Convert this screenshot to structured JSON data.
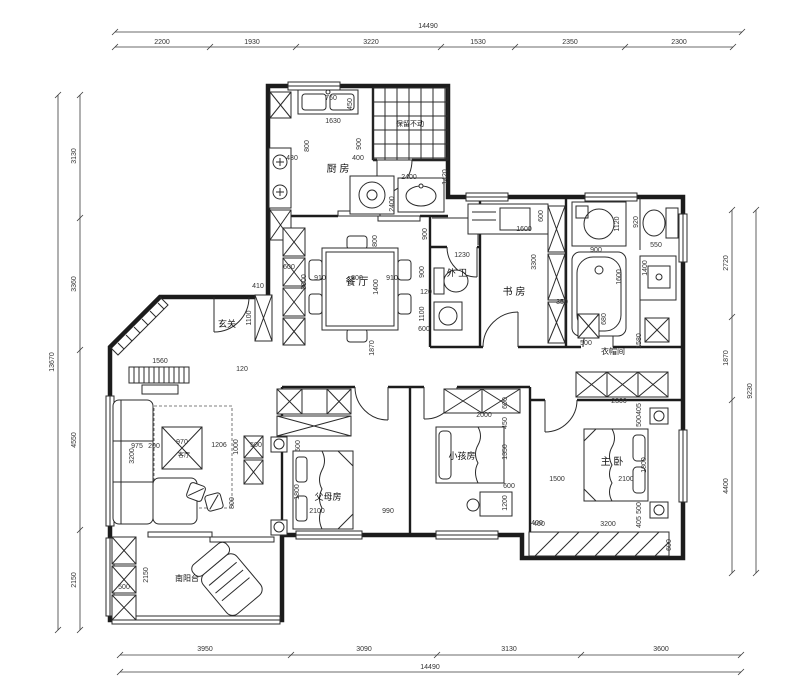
{
  "plan": {
    "rooms": [
      {
        "name": "厨 房",
        "x": 338,
        "y": 172,
        "s": 10
      },
      {
        "name": "保留不动",
        "x": 410,
        "y": 126,
        "s": 7
      },
      {
        "name": "餐 厅",
        "x": 357,
        "y": 285,
        "s": 10
      },
      {
        "name": "玄关",
        "x": 227,
        "y": 327,
        "s": 9
      },
      {
        "name": "外 卫",
        "x": 457,
        "y": 276,
        "s": 9
      },
      {
        "name": "书 房",
        "x": 514,
        "y": 295,
        "s": 10
      },
      {
        "name": "衣帽间",
        "x": 613,
        "y": 354,
        "s": 8
      },
      {
        "name": "客厅",
        "x": 184,
        "y": 457,
        "s": 6
      },
      {
        "name": "父母房",
        "x": 328,
        "y": 500,
        "s": 9
      },
      {
        "name": "小孩房",
        "x": 462,
        "y": 459,
        "s": 9
      },
      {
        "name": "主 卧",
        "x": 612,
        "y": 465,
        "s": 10
      },
      {
        "name": "南阳台",
        "x": 187,
        "y": 581,
        "s": 8
      }
    ],
    "annotations": [
      {
        "t": "14490",
        "x": 428,
        "y": 28
      },
      {
        "t": "2200",
        "x": 162,
        "y": 44
      },
      {
        "t": "1930",
        "x": 252,
        "y": 44
      },
      {
        "t": "3220",
        "x": 371,
        "y": 44
      },
      {
        "t": "1530",
        "x": 478,
        "y": 44
      },
      {
        "t": "2350",
        "x": 570,
        "y": 44
      },
      {
        "t": "2300",
        "x": 679,
        "y": 44
      },
      {
        "t": "3950",
        "x": 205,
        "y": 651
      },
      {
        "t": "3090",
        "x": 364,
        "y": 651
      },
      {
        "t": "3130",
        "x": 509,
        "y": 651
      },
      {
        "t": "3600",
        "x": 661,
        "y": 651
      },
      {
        "t": "14490",
        "x": 430,
        "y": 669
      },
      {
        "t": "13670",
        "x": 54,
        "y": 362,
        "r": 1
      },
      {
        "t": "3130",
        "x": 76,
        "y": 156,
        "r": 1
      },
      {
        "t": "3360",
        "x": 76,
        "y": 284,
        "r": 1
      },
      {
        "t": "4550",
        "x": 76,
        "y": 440,
        "r": 1
      },
      {
        "t": "2150",
        "x": 76,
        "y": 580,
        "r": 1
      },
      {
        "t": "2720",
        "x": 728,
        "y": 263,
        "r": 1
      },
      {
        "t": "1870",
        "x": 728,
        "y": 358,
        "r": 1
      },
      {
        "t": "4400",
        "x": 728,
        "y": 486,
        "r": 1
      },
      {
        "t": "9230",
        "x": 752,
        "y": 391,
        "r": 1
      },
      {
        "t": "760",
        "x": 331,
        "y": 100
      },
      {
        "t": "450",
        "x": 352,
        "y": 104,
        "r": 1
      },
      {
        "t": "1630",
        "x": 333,
        "y": 123
      },
      {
        "t": "800",
        "x": 309,
        "y": 146,
        "r": 1
      },
      {
        "t": "900",
        "x": 361,
        "y": 144,
        "r": 1
      },
      {
        "t": "430",
        "x": 292,
        "y": 160
      },
      {
        "t": "400",
        "x": 358,
        "y": 160
      },
      {
        "t": "2400",
        "x": 409,
        "y": 179
      },
      {
        "t": "1420",
        "x": 447,
        "y": 177,
        "r": 1
      },
      {
        "t": "2400",
        "x": 394,
        "y": 204,
        "r": 1
      },
      {
        "t": "600",
        "x": 289,
        "y": 269
      },
      {
        "t": "910",
        "x": 320,
        "y": 280
      },
      {
        "t": "800",
        "x": 357,
        "y": 280
      },
      {
        "t": "910",
        "x": 392,
        "y": 280
      },
      {
        "t": "1400",
        "x": 378,
        "y": 287,
        "r": 1
      },
      {
        "t": "800",
        "x": 377,
        "y": 241,
        "r": 1
      },
      {
        "t": "3000",
        "x": 306,
        "y": 282,
        "r": 1
      },
      {
        "t": "1870",
        "x": 374,
        "y": 348,
        "r": 1
      },
      {
        "t": "410",
        "x": 258,
        "y": 288
      },
      {
        "t": "1100",
        "x": 251,
        "y": 318,
        "r": 1
      },
      {
        "t": "120",
        "x": 242,
        "y": 371
      },
      {
        "t": "1230",
        "x": 462,
        "y": 257
      },
      {
        "t": "900",
        "x": 427,
        "y": 234,
        "r": 1
      },
      {
        "t": "900",
        "x": 424,
        "y": 272,
        "r": 1
      },
      {
        "t": "120",
        "x": 426,
        "y": 294
      },
      {
        "t": "1100",
        "x": 424,
        "y": 314,
        "r": 1
      },
      {
        "t": "600",
        "x": 424,
        "y": 331
      },
      {
        "t": "600",
        "x": 543,
        "y": 216,
        "r": 1
      },
      {
        "t": "1600",
        "x": 524,
        "y": 231
      },
      {
        "t": "3300",
        "x": 536,
        "y": 262,
        "r": 1
      },
      {
        "t": "350",
        "x": 562,
        "y": 304
      },
      {
        "t": "900",
        "x": 596,
        "y": 252
      },
      {
        "t": "1120",
        "x": 619,
        "y": 224,
        "r": 1
      },
      {
        "t": "1600",
        "x": 621,
        "y": 277,
        "r": 1
      },
      {
        "t": "920",
        "x": 638,
        "y": 222,
        "r": 1
      },
      {
        "t": "550",
        "x": 656,
        "y": 247
      },
      {
        "t": "1400",
        "x": 647,
        "y": 268,
        "r": 1
      },
      {
        "t": "500",
        "x": 586,
        "y": 345
      },
      {
        "t": "680",
        "x": 606,
        "y": 319,
        "r": 1
      },
      {
        "t": "1580",
        "x": 641,
        "y": 341,
        "r": 1
      },
      {
        "t": "2300",
        "x": 619,
        "y": 403
      },
      {
        "t": "405",
        "x": 641,
        "y": 409,
        "r": 1
      },
      {
        "t": "500",
        "x": 641,
        "y": 421,
        "r": 1
      },
      {
        "t": "1800",
        "x": 646,
        "y": 465,
        "r": 1
      },
      {
        "t": "2100",
        "x": 626,
        "y": 481
      },
      {
        "t": "1500",
        "x": 557,
        "y": 481
      },
      {
        "t": "500",
        "x": 641,
        "y": 508,
        "r": 1
      },
      {
        "t": "405",
        "x": 641,
        "y": 522,
        "r": 1
      },
      {
        "t": "400",
        "x": 539,
        "y": 526
      },
      {
        "t": "3200",
        "x": 608,
        "y": 526
      },
      {
        "t": "600",
        "x": 671,
        "y": 545,
        "r": 1
      },
      {
        "t": "2000",
        "x": 484,
        "y": 417
      },
      {
        "t": "600",
        "x": 507,
        "y": 403,
        "r": 1
      },
      {
        "t": "450",
        "x": 507,
        "y": 423,
        "r": 1
      },
      {
        "t": "1350",
        "x": 507,
        "y": 452,
        "r": 1
      },
      {
        "t": "600",
        "x": 509,
        "y": 488
      },
      {
        "t": "1200",
        "x": 507,
        "y": 503,
        "r": 1
      },
      {
        "t": "400",
        "x": 537,
        "y": 525
      },
      {
        "t": "500",
        "x": 300,
        "y": 446,
        "r": 1
      },
      {
        "t": "1800",
        "x": 299,
        "y": 492,
        "r": 1
      },
      {
        "t": "2100",
        "x": 317,
        "y": 513
      },
      {
        "t": "990",
        "x": 388,
        "y": 513
      },
      {
        "t": "1560",
        "x": 160,
        "y": 363
      },
      {
        "t": "3200",
        "x": 134,
        "y": 456,
        "r": 1
      },
      {
        "t": "975",
        "x": 137,
        "y": 448
      },
      {
        "t": "200",
        "x": 154,
        "y": 448
      },
      {
        "t": "970",
        "x": 182,
        "y": 444
      },
      {
        "t": "1206",
        "x": 219,
        "y": 447
      },
      {
        "t": "1000",
        "x": 238,
        "y": 447,
        "r": 1
      },
      {
        "t": "500",
        "x": 256,
        "y": 447
      },
      {
        "t": "800",
        "x": 234,
        "y": 503,
        "r": 1
      },
      {
        "t": "2150",
        "x": 148,
        "y": 575,
        "r": 1
      },
      {
        "t": "500",
        "x": 124,
        "y": 589
      }
    ]
  }
}
